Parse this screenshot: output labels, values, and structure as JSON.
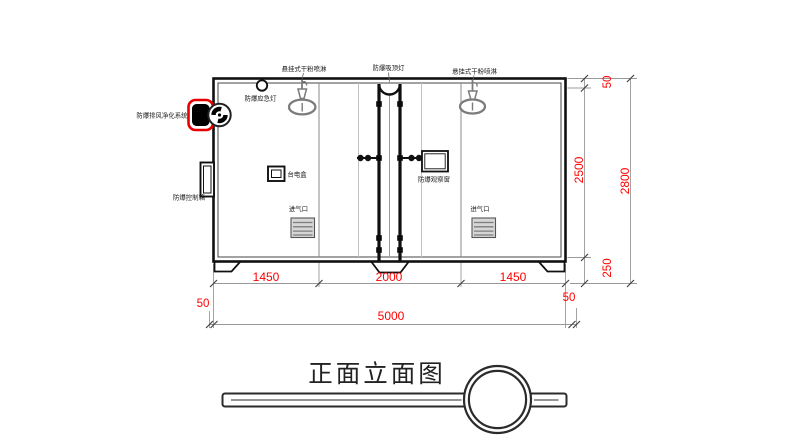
{
  "title": {
    "text": "正面立面图"
  },
  "labels": {
    "sprinkler_left": "悬挂式干粉喷淋",
    "ceiling_lamp": "防爆吸顶灯",
    "sprinkler_right": "悬挂式干粉喷淋",
    "emergency_lamp": "防爆应急灯",
    "purification_system": "防爆排风净化系统",
    "control_box": "防爆控制箱",
    "power_box": "台电盒",
    "observation_window": "防爆观察窗",
    "air_inlet_left": "进气口",
    "air_inlet_right": "进气口"
  },
  "dimensions": {
    "widths": [
      "1450",
      "2000",
      "1450"
    ],
    "total_width": "5000",
    "side_margin_left": "50",
    "side_margin_right": "50",
    "heights": [
      "50",
      "2500",
      "250"
    ],
    "total_height": "2800"
  },
  "colors": {
    "dimension_text": "#ff0000",
    "device_highlight": "#e60000",
    "line": "#1a1a1a",
    "fixture_gray": "#7b7b7b"
  }
}
